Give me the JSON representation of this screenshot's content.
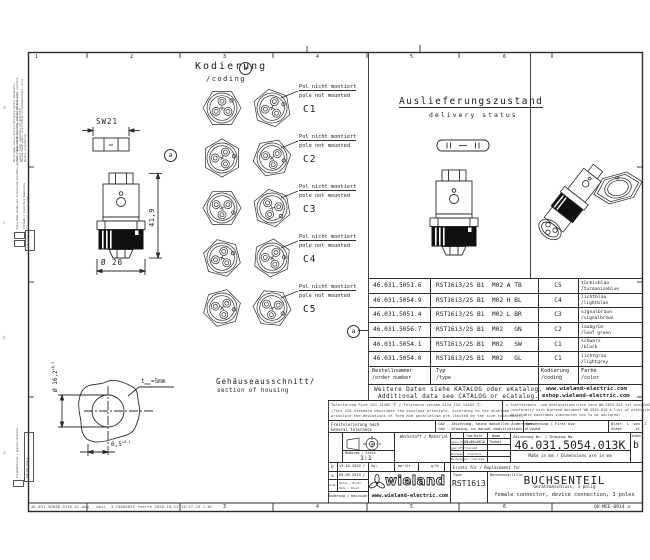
{
  "frame": {
    "zones_top": [
      "1",
      "2",
      "3",
      "4",
      "5",
      "6"
    ],
    "zones_bottom": [
      "3",
      "4",
      "5",
      "6"
    ],
    "zone_letters": [
      "d",
      "c",
      "b",
      "a"
    ],
    "footer_meta": "46_031_5004B.013K-AC-dwg_._mair_.3    CAD#4055-foerth  2020-10-12T10:37:23    1.0C",
    "doc_code": "QU-MEE-0914 a"
  },
  "margin": {
    "confidentiality_1": "Weitergabe sowie Vervielfältigung dieses Dokuments, Verwertung und Mitteilung seines Inhalts sind verboten, soweit nicht ausdrücklich gestattet.",
    "confidentiality_2": "Zuwiderhandlungen verpflichten zu Schadenersatz. Alle Rechte vorbehalten.",
    "legend_1": "Diese Maße werden bei Anlieferung besonders geprüft / dimensions specially checked at delivery",
    "legend_2": "Prüfmaße / inspection dimensions",
    "legend_3": "CAD-Artikel, Änderungen nur über CAD",
    "legend_4": "Freimaßtoleranz / general tolerance",
    "legend_5": "DIN ISO 2768-m"
  },
  "views": {
    "coding_title_de": "Kodierung",
    "coding_title_en": "/coding",
    "pole_note_de": "Pol nicht montiert",
    "pole_note_en": "pole not mounted",
    "codes": [
      {
        "id": "C1"
      },
      {
        "id": "C2"
      },
      {
        "id": "C3"
      },
      {
        "id": "C4"
      },
      {
        "id": "C5"
      }
    ],
    "delivery_title_de": "Auslieferungszustand",
    "delivery_title_en": "delivery status",
    "housing_title_de": "Gehäuseausschnitt/",
    "housing_title_en": "section of housing",
    "marker_a": "a",
    "marker_b": "b"
  },
  "dims": {
    "sw": "SW21",
    "height": "41,9",
    "dia": "Ø 20",
    "cutout_dia": "Ø 16,2",
    "cutout_dia_tol": "+0,1",
    "t_label": "t",
    "t_sub": "max",
    "t_value": "=5mm",
    "cutout_w": "6,5",
    "cutout_w_tol": "+0,1"
  },
  "table": {
    "header": {
      "order_de": "Bestellnummer",
      "order_en": "/order number",
      "type_de": "Typ",
      "type_en": "/type",
      "coding_de": "Kodierung",
      "coding_en": "/coding",
      "color_de": "Farbe",
      "color_en": "/color"
    },
    "rows": [
      {
        "order": "46.031.5051.6",
        "type": "RST16i3/2S B1  M02 A TB",
        "coding": "C5",
        "color_de": "türkisblau",
        "color_en": "/turquoiseblue"
      },
      {
        "order": "46.031.5054.9",
        "type": "RST16i3/2S B1  M02 H BL",
        "coding": "C4",
        "color_de": "lichtblau",
        "color_en": "/lightblue"
      },
      {
        "order": "46.031.5051.4",
        "type": "RST16i3/2S B1  M02 L BR",
        "coding": "C3",
        "color_de": "signalbraun",
        "color_en": "/signalbrown"
      },
      {
        "order": "46.031.5056.7",
        "type": "RST16i3/2S B1  M02   GN",
        "coding": "C2",
        "color_de": "laubgrün",
        "color_en": "/leaf green"
      },
      {
        "order": "46.031.5054.1",
        "type": "RST16i3/2S B1  M02   SW",
        "coding": "C1",
        "color_de": "schwarz",
        "color_en": "/black"
      },
      {
        "order": "46.031.5054.0",
        "type": "RST16i3/2S B1  M02   GL",
        "coding": "C1",
        "color_de": "lichtgrau",
        "color_en": "/lightgrey"
      }
    ],
    "note_de": "Weitere Daten siehe KATALOG oder eKatalog.",
    "note_en": "Additional data see CATALOG or eCatalog.",
    "web_1": "www.wieland-electric.com",
    "web_2": "eshop.wieland-electric.com"
  },
  "notes": {
    "tol_1": "Tolerierung Size ISO 14405 Ⓔ  /  Tolerance system Size ISO 14405 Ⓔ.",
    "tol_2": "(This ISO-Standard describes the envelope principle. According to the envelope",
    "tol_3": "principle the deviations of form and parallelism are limited by the size tolerances)",
    "subst_1": "☒ Stoffverbots- und Deklarationsliste nach WN 5029.810 ist einzuhalten",
    "subst_2": "(conformity with Wieland document WN 5029.810 a list of prohibited /",
    "subst_3": "declarable hazardous substances has to be declared)",
    "gentol_de": "Freitolerierung nach",
    "gentol_en": "General tolerance",
    "cad_de": "CAD - Zeichnung, keine manuellen Änderungen",
    "cad_en": "CAD - drawing, no manual modifications allowed",
    "usage": "Verwendung / First Use",
    "sheet_line1": "Blatt  1  von  1",
    "sheet_line2": "Sheet      of"
  },
  "tb": {
    "material_label": "Werkstoff / Material",
    "scale_label": "Maßstab / Scale",
    "scale": "1:1",
    "vol": "Vol.",
    "vol_u1": "mm³/St.",
    "vol_u2": "g/St.",
    "date_h": "Tag/Date",
    "name_h": "Name",
    "rows": [
      {
        "label": "gezeichnet/drawn",
        "date": "23.07.2016",
        "name": "Thobel"
      },
      {
        "label": "geprüft/checked",
        "date": "",
        "name": ""
      },
      {
        "label": "Normgepr./checked",
        "date": "",
        "name": ""
      },
      {
        "label": "Werkstgepr./checked",
        "date": "",
        "name": ""
      }
    ],
    "drawing_no_label": "Zeichnung Nr. / Drawing No.",
    "drawing_no": "46.031.5054.013K",
    "index_label": "Index",
    "index": "b",
    "mm_note": "Maße in mm / Dimensions are in mm",
    "replacement": "Ersatz für / Replacement for",
    "type_label": "Type",
    "type": "RST16i3",
    "title_label": "Benennung/Title",
    "title": "BUCHSENTEIL",
    "subtitle_de": "Geräteanschluss, 3-polig",
    "subtitle_en": "female connector, device connection, 3 poles",
    "logo": "wieland",
    "logo_url": "www.wieland-electric.com",
    "rev": [
      {
        "i": "b",
        "d": "13.10.2020 /"
      },
      {
        "i": "a",
        "d": "09.05.2019 /"
      }
    ],
    "rev_index": "Index",
    "rev_date_1": "Datum / Blatt",
    "rev_date_2": "Date / Sheet",
    "rev_change": "Änderung / Revision"
  }
}
